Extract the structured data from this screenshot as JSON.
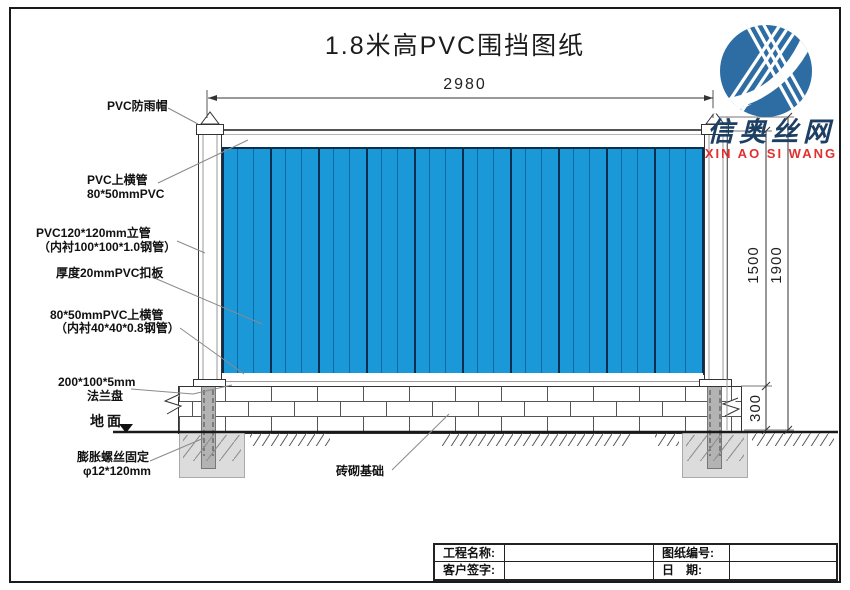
{
  "title": "1.8米高PVC围挡图纸",
  "logo": {
    "name_cn": "信奥丝网",
    "name_en": "XIN AO SI WANG"
  },
  "dims": {
    "top_width": "2980",
    "height_panel": "1500",
    "height_total": "1900",
    "height_base": "300"
  },
  "callouts": {
    "rain_cap": "PVC防雨帽",
    "top_rail_line1": "PVC上横管",
    "top_rail_line2": "80*50mmPVC",
    "post_line1": "PVC120*120mm立管",
    "post_line2": "（内衬100*100*1.0钢管）",
    "panel": "厚度20mmPVC扣板",
    "mid_rail_line1": "80*50mmPVC上横管",
    "mid_rail_line2": "（内衬40*40*0.8钢管）",
    "flange_line1": "200*100*5mm",
    "flange_line2": "法兰盘",
    "ground": "地面",
    "anchor_line1": "膨胀螺丝固定",
    "anchor_line2": "φ12*120mm",
    "brick_foundation": "砖砌基础"
  },
  "title_block": {
    "project_label": "工程名称:",
    "project_value": "",
    "drawing_no_label": "图纸编号:",
    "drawing_no_value": "",
    "client_label": "客户签字:",
    "client_value": "",
    "date_label": "日　期:",
    "date_value": ""
  },
  "colors": {
    "panel_blue": "#1b98d8",
    "panel_groove": "#0d6aa8",
    "panel_divider": "#0a2e4d",
    "logo_circle": "#2d6da3",
    "logo_text_blue": "#1d3f63",
    "logo_text_red": "#e03030",
    "foundation_gray": "#dcdcdc",
    "steel_gray": "#b3b3b3"
  }
}
